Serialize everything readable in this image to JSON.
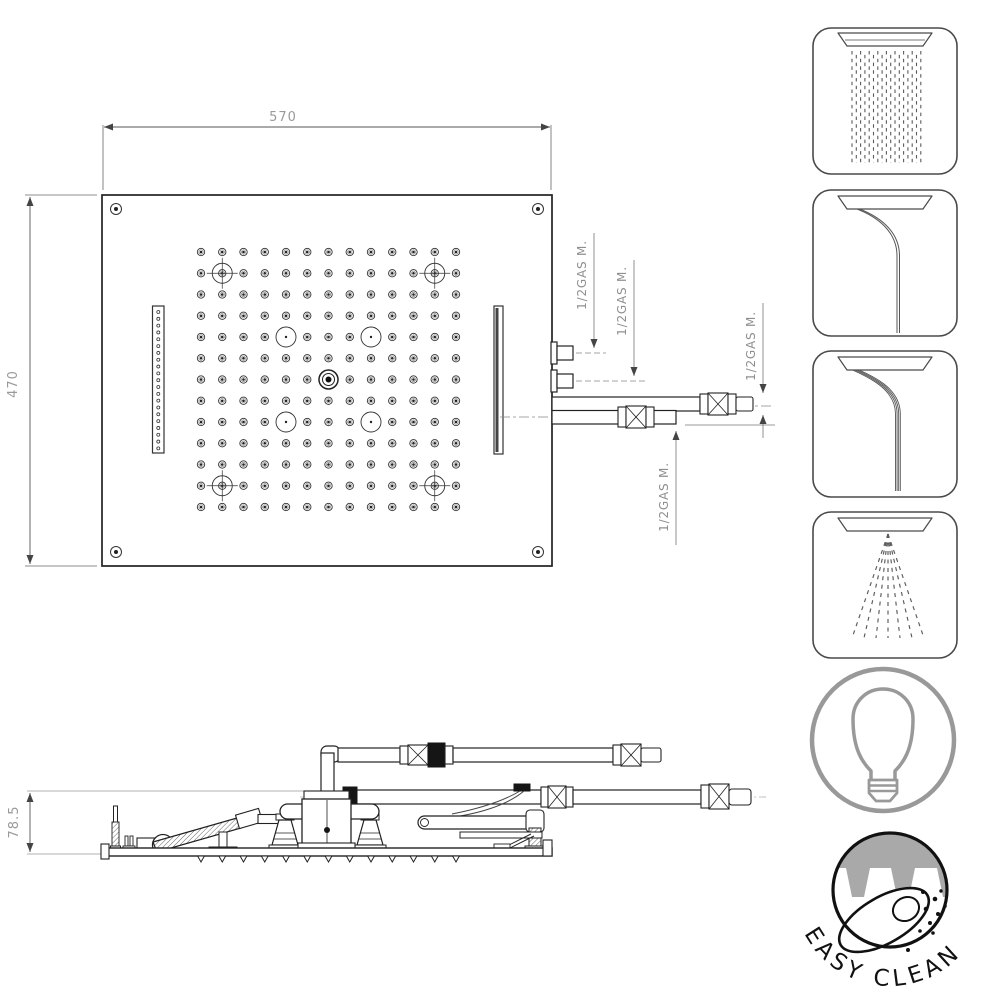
{
  "drawing_title": "ceiling-shower-head-technical-drawing",
  "dimensions": {
    "top_width": "570",
    "top_height": "470",
    "side_height": "78.5"
  },
  "connections": {
    "labels": [
      "1/2GAS M.",
      "1/2GAS M.",
      "1/2GAS M.",
      "1/2GAS M."
    ]
  },
  "badge": {
    "text": "EASY CLEAN"
  },
  "features": [
    "rain",
    "waterfall",
    "cascade",
    "mist",
    "led-light",
    "easy-clean"
  ],
  "colors": {
    "line": "#222222",
    "dim_text": "#9a9a9a",
    "gas_text": "#8f8f8f",
    "icon_stroke": "#4a4a4a",
    "bulb_gray": "#999999",
    "badge_black": "#111111",
    "badge_gray_fill": "#a9a9a9"
  },
  "geometry": {
    "grid": {
      "cols": 13,
      "rows": 13,
      "origin_x": 201,
      "origin_y": 252,
      "spacing": 21.25,
      "crosshair_positions": [
        [
          1,
          1
        ],
        [
          11,
          1
        ],
        [
          1,
          11
        ],
        [
          11,
          11
        ]
      ],
      "plain_circle_positions": [
        [
          4,
          4
        ],
        [
          8,
          4
        ],
        [
          4,
          8
        ],
        [
          8,
          8
        ]
      ],
      "center_position": [
        6,
        6
      ]
    },
    "slot_dots": {
      "count": 21,
      "x": 158.3,
      "y_start": 312,
      "spacing": 6.82
    },
    "side_nozzles": {
      "count": 13,
      "x_start": 201,
      "spacing": 21.25,
      "y": 856
    },
    "rain": {
      "columns": 17,
      "x_start": 852,
      "spacing": 4.3,
      "y_top": 51,
      "y_bottom": 163
    },
    "mist": {
      "count": 7,
      "origin": [
        888,
        534
      ],
      "x_start": 852,
      "x_end": 924,
      "y_end": 638
    },
    "waterfall": {
      "count": 2
    },
    "cascade": {
      "count": 4
    }
  }
}
